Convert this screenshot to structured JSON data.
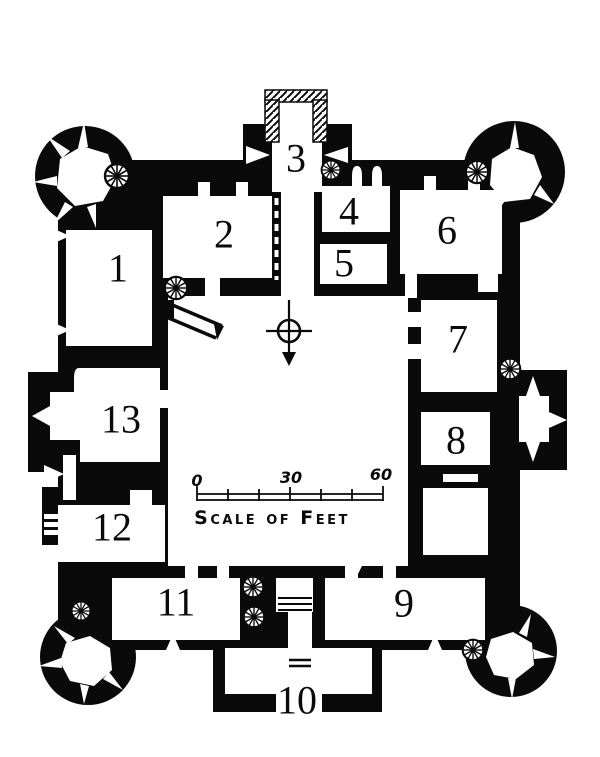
{
  "figure": {
    "type": "architectural-floor-plan",
    "subject": "Quadrangular castle ground plan with four round corner towers, north gatehouse, south postern and numbered rooms"
  },
  "room_labels": [
    {
      "label": "1",
      "x": 118,
      "y": 268
    },
    {
      "label": "2",
      "x": 224,
      "y": 234
    },
    {
      "label": "3",
      "x": 296,
      "y": 158
    },
    {
      "label": "4",
      "x": 349,
      "y": 211
    },
    {
      "label": "5",
      "x": 344,
      "y": 263
    },
    {
      "label": "6",
      "x": 447,
      "y": 230
    },
    {
      "label": "7",
      "x": 458,
      "y": 339
    },
    {
      "label": "8",
      "x": 456,
      "y": 440
    },
    {
      "label": "9",
      "x": 404,
      "y": 603
    },
    {
      "label": "10",
      "x": 297,
      "y": 700
    },
    {
      "label": "11",
      "x": 176,
      "y": 602
    },
    {
      "label": "12",
      "x": 112,
      "y": 527
    },
    {
      "label": "13",
      "x": 121,
      "y": 419
    }
  ],
  "scale_bar": {
    "tick_labels": [
      "0",
      "30",
      "60"
    ],
    "caption": "Scale of Feet"
  },
  "icons": {
    "compass_icon": "compass-cross-south-arrow",
    "stair_icon": "spiral-stair",
    "hatch_icon": "hatched-porch-wall"
  },
  "colors": {
    "ink": "#0a0a0a",
    "paper": "#ffffff"
  }
}
